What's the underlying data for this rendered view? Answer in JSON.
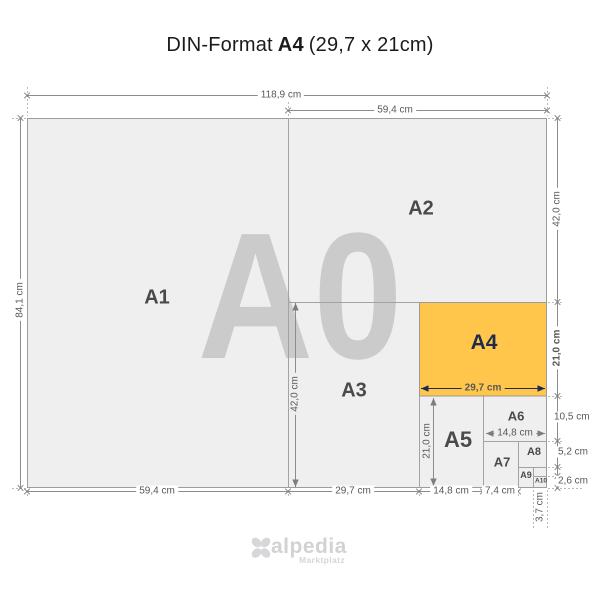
{
  "title": {
    "part1": "DIN-Format",
    "part2": "A4",
    "part3": "(29,7 x 21cm)"
  },
  "watermark": "A0",
  "formats": {
    "a1": "A1",
    "a2": "A2",
    "a3": "A3",
    "a4": "A4",
    "a5": "A5",
    "a6": "A6",
    "a7": "A7",
    "a8": "A8",
    "a9": "A9",
    "a10": "A10"
  },
  "dims": {
    "total_width": "118,9 cm",
    "a2_width": "59,4 cm",
    "total_height": "84,1 cm",
    "a2_height": "42,0 cm",
    "a4_height": "21,0 cm",
    "a4_width": "29,7 cm",
    "a3_height": "42,0 cm",
    "a5_height": "21,0 cm",
    "a6_width": "14,8 cm",
    "a6_height": "10,5 cm",
    "a8_height": "5,2 cm",
    "a10_height": "2,6 cm",
    "a10_width": "3,7 cm",
    "bottom_a1_width": "59,4 cm",
    "bottom_a3_width": "29,7 cm",
    "bottom_a5_width": "14,8 cm",
    "bottom_a7_width": "7,4 cm"
  },
  "colors": {
    "highlight_orange": "#FFC64B",
    "navy_text": "#1D2B4C",
    "sheet_gray": "#EFEFEF",
    "line_gray": "#9D9D9D",
    "watermark_gray": "#CBCBCB"
  },
  "logo": {
    "name": "alpedia",
    "tagline": "Marktplatz"
  }
}
